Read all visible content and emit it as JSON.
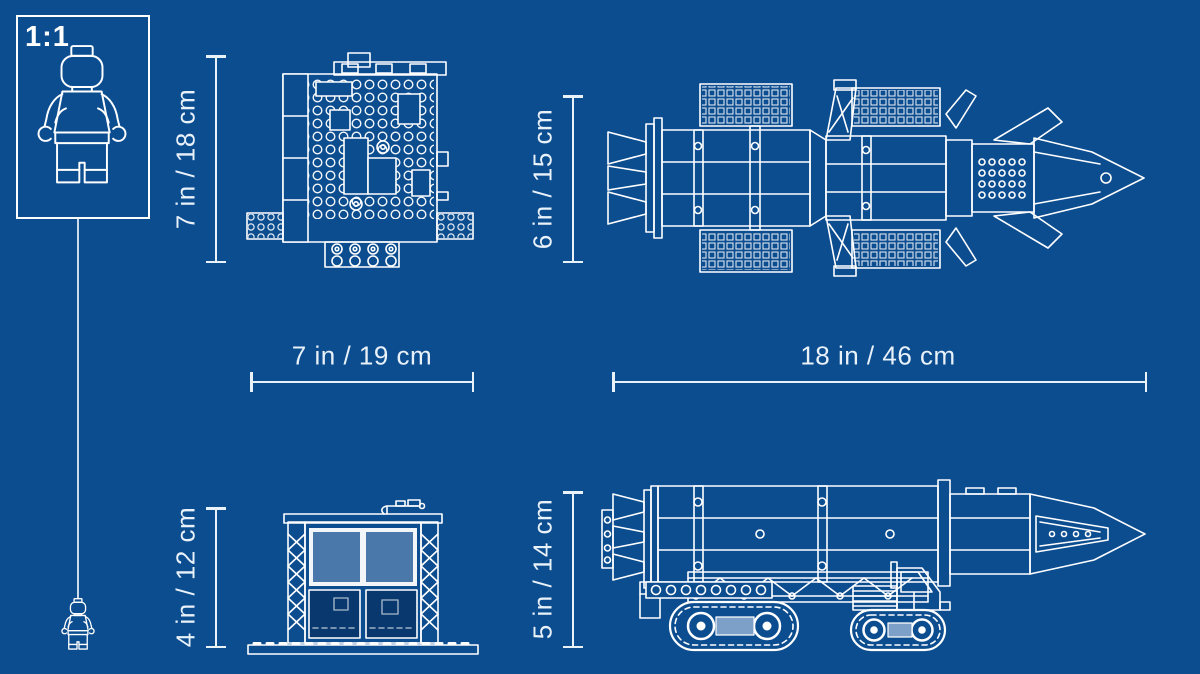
{
  "canvas": {
    "width": 1200,
    "height": 674
  },
  "palette": {
    "background": "#0C4D90",
    "line": "#FFFFFF",
    "dimension_text": "#E9F1F9",
    "window_pane": "#4A78AA",
    "tread_pad": "#7DA0C8"
  },
  "scale_box": {
    "label": "1:1"
  },
  "dimensions": {
    "building_height": "7 in / 18 cm",
    "building_width": "7 in / 19 cm",
    "transporter_top_height": "6 in / 15 cm",
    "transporter_length": "18 in / 46 cm",
    "building_side_height": "4 in / 12 cm",
    "transporter_side_height": "5 in / 14 cm"
  }
}
